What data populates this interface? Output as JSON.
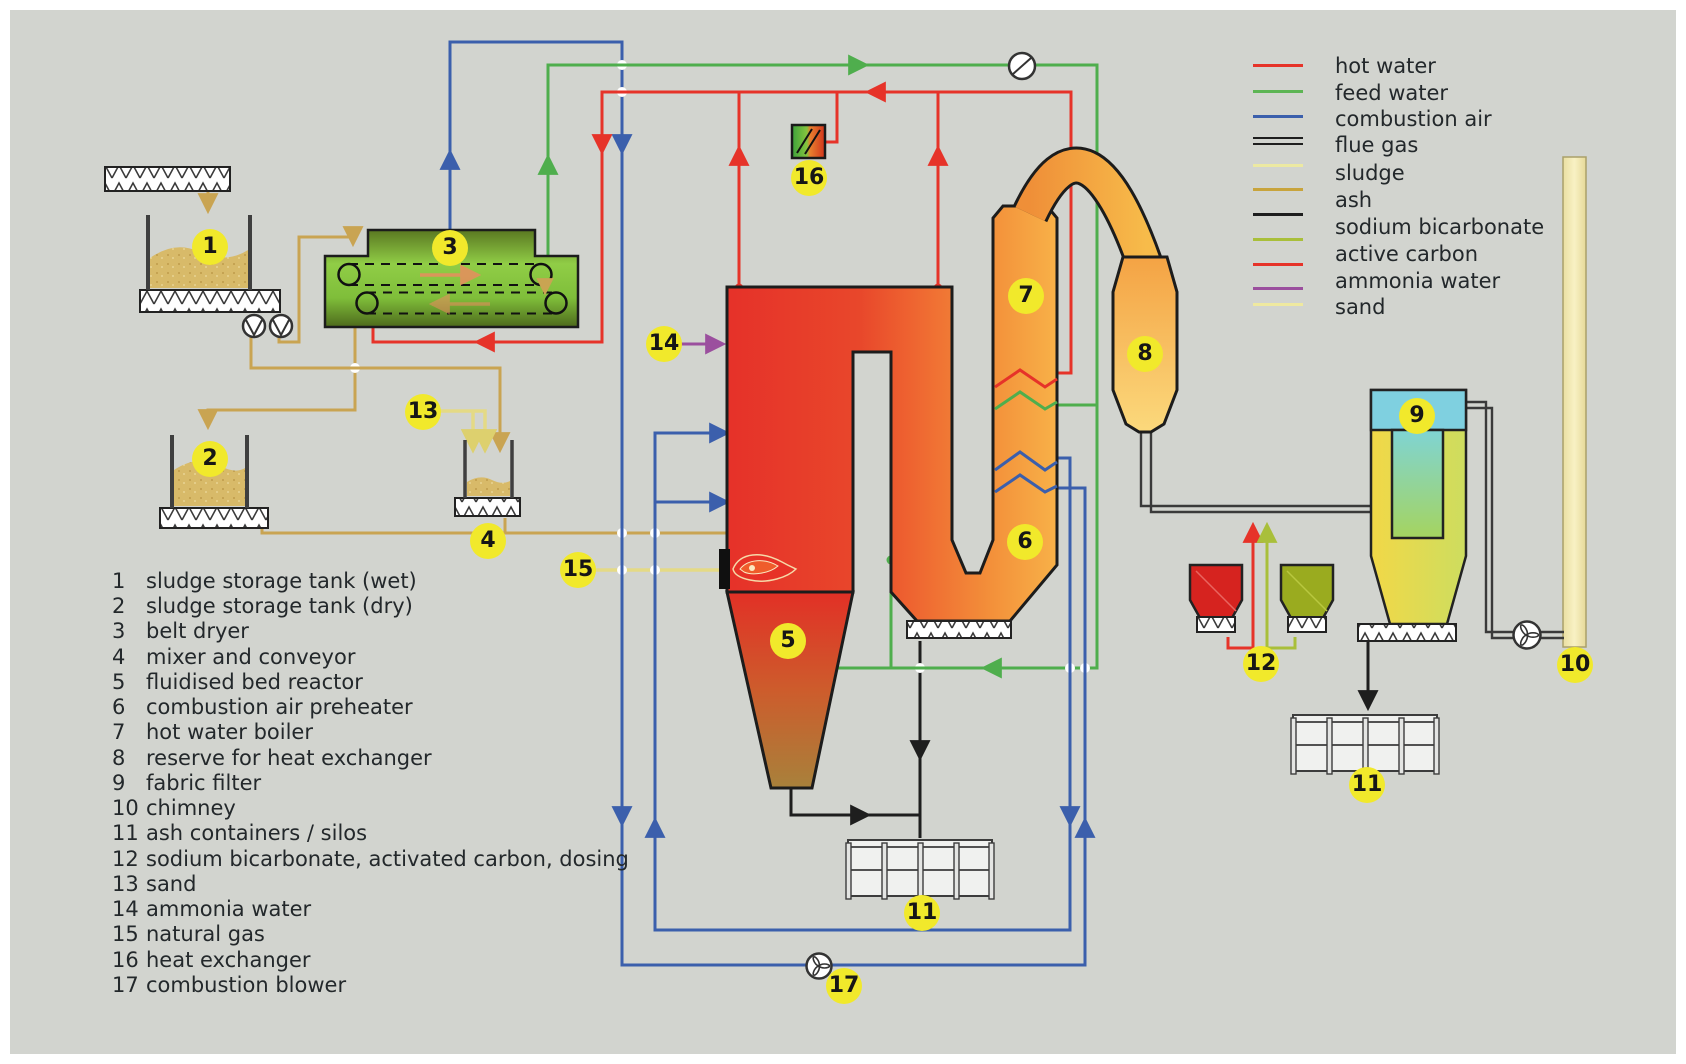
{
  "legend": {
    "items": [
      {
        "label": "hot water",
        "color": "#e63329"
      },
      {
        "label": "feed water",
        "color": "#5db554"
      },
      {
        "label": "combustion air",
        "color": "#3b5fac"
      },
      {
        "label": "flue gas",
        "color": "#1e1e1e",
        "style": "double-line"
      },
      {
        "label": "sludge",
        "color": "#ece9a2"
      },
      {
        "label": "ash",
        "color": "#c8a43c"
      },
      {
        "label": "sodium bicarbonate",
        "color": "#1e1e1e"
      },
      {
        "label": "active carbon",
        "color": "#a9bf3a"
      },
      {
        "label": "ammonia water",
        "color": "#e63329"
      },
      {
        "label": "sand",
        "color": "#9b4f9e"
      }
    ],
    "swatch_colors": [
      "#e63329",
      "#5db554",
      "#3b5fac",
      "double-black",
      "#ece9a2",
      "#c8a43c",
      "#1e1e1e",
      "#a9bf3a",
      "#e63329",
      "#9b4f9e",
      "#efe9a0"
    ]
  },
  "list": {
    "items": [
      {
        "num": "1",
        "label": "sludge storage tank (wet)"
      },
      {
        "num": "2",
        "label": "sludge storage tank (dry)"
      },
      {
        "num": "3",
        "label": "belt dryer"
      },
      {
        "num": "4",
        "label": "mixer and conveyor"
      },
      {
        "num": "5",
        "label": "fluidised bed reactor"
      },
      {
        "num": "6",
        "label": "combustion air preheater"
      },
      {
        "num": "7",
        "label": "hot water boiler"
      },
      {
        "num": "8",
        "label": "reserve for heat exchanger"
      },
      {
        "num": "9",
        "label": "fabric filter"
      },
      {
        "num": "10",
        "label": "chimney"
      },
      {
        "num": "11",
        "label": "ash containers / silos"
      },
      {
        "num": "12",
        "label": "sodium bicarbonate, activated carbon, dosing"
      },
      {
        "num": "13",
        "label": "sand"
      },
      {
        "num": "14",
        "label": "ammonia water"
      },
      {
        "num": "15",
        "label": "natural gas"
      },
      {
        "num": "16",
        "label": "heat exchanger"
      },
      {
        "num": "17",
        "label": "combustion blower"
      }
    ]
  },
  "badges": [
    "1",
    "2",
    "3",
    "4",
    "5",
    "6",
    "7",
    "8",
    "9",
    "10",
    "11",
    "12",
    "13",
    "14",
    "15",
    "16",
    "17",
    "11"
  ],
  "colors": {
    "background": "#d2d4cf",
    "hot_water": "#e63329",
    "feed_water": "#5db554",
    "combustion_air": "#3b5fac",
    "flue_gas": "#3a3a3a",
    "sludge_line": "#c9a452",
    "ash_line": "#1e1e1e",
    "sodium_bicarbonate_line": "#a9bf3a",
    "active_carbon_line": "#e63329",
    "ammonia_line": "#9b4f9e",
    "sand_line": "#e8df8f",
    "badge": "#f1e92b"
  }
}
